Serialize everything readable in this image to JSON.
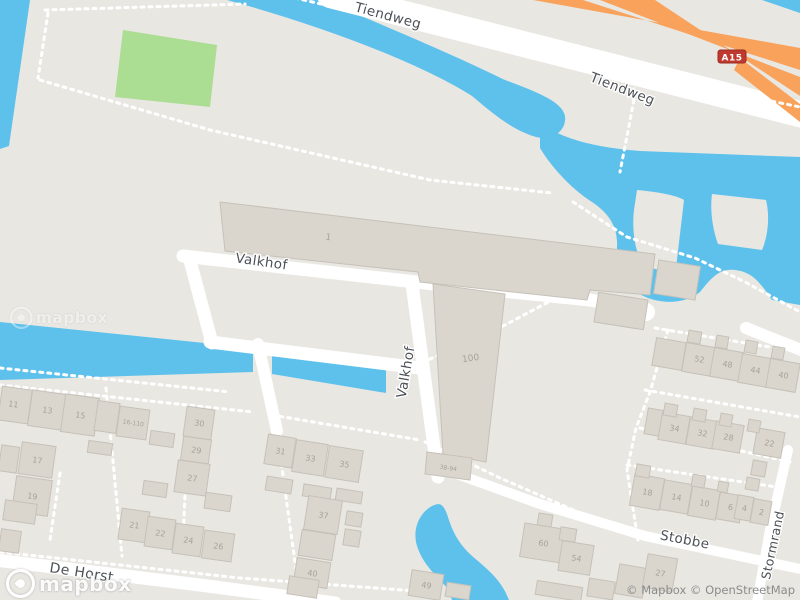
{
  "colors": {
    "land": "#e9e7e2",
    "water": "#5ec1ec",
    "park": "#abdd93",
    "motorway": "#f8a25c",
    "road": "#ffffff",
    "building_fill": "#dad6ce",
    "building_stroke": "#c6c1b8",
    "shield_bg": "#c0392e",
    "shield_border": "#9c2a22",
    "street_label": "#4c5157",
    "house_number": "#a8a298"
  },
  "motorway_shield": {
    "text": "A15"
  },
  "streets": [
    {
      "name": "street-label-tiendweg-1",
      "text": "Tiendweg",
      "x": 387,
      "y": 20,
      "rot": 15,
      "size": 13.5
    },
    {
      "name": "street-label-tiendweg-2",
      "text": "Tiendweg",
      "x": 621,
      "y": 93,
      "rot": 21,
      "size": 13.5
    },
    {
      "name": "street-label-valkhof-1",
      "text": "Valkhof",
      "x": 261,
      "y": 266,
      "rot": 8,
      "size": 13.5
    },
    {
      "name": "street-label-valkhof-2",
      "text": "Valkhof",
      "x": 410,
      "y": 373,
      "rot": -80,
      "size": 13.5
    },
    {
      "name": "street-label-de-horst",
      "text": "De Horst",
      "x": 81,
      "y": 577,
      "rot": 9,
      "size": 14
    },
    {
      "name": "street-label-stobbe",
      "text": "Stobbe",
      "x": 684,
      "y": 544,
      "rot": 11,
      "size": 13.5
    },
    {
      "name": "street-label-stormrand",
      "text": "Stormrand",
      "x": 777,
      "y": 546,
      "rot": -78,
      "size": 12.5
    }
  ],
  "house_numbers": [
    {
      "text": "1",
      "x": 328,
      "y": 240,
      "rot": 8,
      "size": 9
    },
    {
      "text": "100",
      "x": 471,
      "y": 361,
      "rot": -8,
      "size": 9
    },
    {
      "text": "38-94",
      "x": 448,
      "y": 470,
      "rot": 8,
      "size": 6
    },
    {
      "text": "11",
      "x": 13,
      "y": 407,
      "rot": 8,
      "size": 8
    },
    {
      "text": "13",
      "x": 47,
      "y": 413,
      "rot": 8,
      "size": 8
    },
    {
      "text": "15",
      "x": 80,
      "y": 418,
      "rot": 8,
      "size": 8
    },
    {
      "text": "16-110",
      "x": 133,
      "y": 425,
      "rot": 8,
      "size": 6
    },
    {
      "text": "30",
      "x": 199,
      "y": 426,
      "rot": 8,
      "size": 8
    },
    {
      "text": "29",
      "x": 196,
      "y": 453,
      "rot": 8,
      "size": 8
    },
    {
      "text": "27",
      "x": 192,
      "y": 481,
      "rot": 8,
      "size": 8
    },
    {
      "text": "17",
      "x": 37,
      "y": 463,
      "rot": 8,
      "size": 8
    },
    {
      "text": "19",
      "x": 32,
      "y": 499,
      "rot": 8,
      "size": 8
    },
    {
      "text": "21",
      "x": 134,
      "y": 528,
      "rot": 8,
      "size": 8
    },
    {
      "text": "22",
      "x": 160,
      "y": 536,
      "rot": 8,
      "size": 8
    },
    {
      "text": "24",
      "x": 188,
      "y": 543,
      "rot": 8,
      "size": 8
    },
    {
      "text": "26",
      "x": 218,
      "y": 549,
      "rot": 8,
      "size": 8
    },
    {
      "text": "31",
      "x": 280,
      "y": 454,
      "rot": 9,
      "size": 8
    },
    {
      "text": "33",
      "x": 310,
      "y": 461,
      "rot": 9,
      "size": 8
    },
    {
      "text": "35",
      "x": 344,
      "y": 467,
      "rot": 9,
      "size": 8
    },
    {
      "text": "37",
      "x": 323,
      "y": 518,
      "rot": 9,
      "size": 8
    },
    {
      "text": "40",
      "x": 312,
      "y": 576,
      "rot": 9,
      "size": 8
    },
    {
      "text": "49",
      "x": 426,
      "y": 588,
      "rot": 9,
      "size": 8
    },
    {
      "text": "60",
      "x": 543,
      "y": 546,
      "rot": 9,
      "size": 8
    },
    {
      "text": "54",
      "x": 576,
      "y": 561,
      "rot": 9,
      "size": 8
    },
    {
      "text": "52",
      "x": 699,
      "y": 362,
      "rot": 10,
      "size": 8
    },
    {
      "text": "48",
      "x": 727,
      "y": 367,
      "rot": 10,
      "size": 8
    },
    {
      "text": "44",
      "x": 755,
      "y": 373,
      "rot": 10,
      "size": 8
    },
    {
      "text": "40",
      "x": 783,
      "y": 378,
      "rot": 10,
      "size": 8
    },
    {
      "text": "34",
      "x": 674,
      "y": 431,
      "rot": 10,
      "size": 8
    },
    {
      "text": "32",
      "x": 702,
      "y": 436,
      "rot": 10,
      "size": 8
    },
    {
      "text": "28",
      "x": 728,
      "y": 440,
      "rot": 10,
      "size": 8
    },
    {
      "text": "22",
      "x": 769,
      "y": 446,
      "rot": 10,
      "size": 8
    },
    {
      "text": "18",
      "x": 647,
      "y": 495,
      "rot": 10,
      "size": 8
    },
    {
      "text": "14",
      "x": 676,
      "y": 500,
      "rot": 10,
      "size": 8
    },
    {
      "text": "10",
      "x": 704,
      "y": 506,
      "rot": 10,
      "size": 8
    },
    {
      "text": "6",
      "x": 730,
      "y": 510,
      "rot": 10,
      "size": 8
    },
    {
      "text": "4",
      "x": 744,
      "y": 511,
      "rot": 10,
      "size": 8
    },
    {
      "text": "2",
      "x": 761,
      "y": 515,
      "rot": 10,
      "size": 8
    },
    {
      "text": "27",
      "x": 660,
      "y": 576,
      "rot": 10,
      "size": 8
    }
  ],
  "branding": {
    "logo_text": "mapbox",
    "watermark_text": "mapbox",
    "attribution": "© Mapbox © OpenStreetMap"
  }
}
